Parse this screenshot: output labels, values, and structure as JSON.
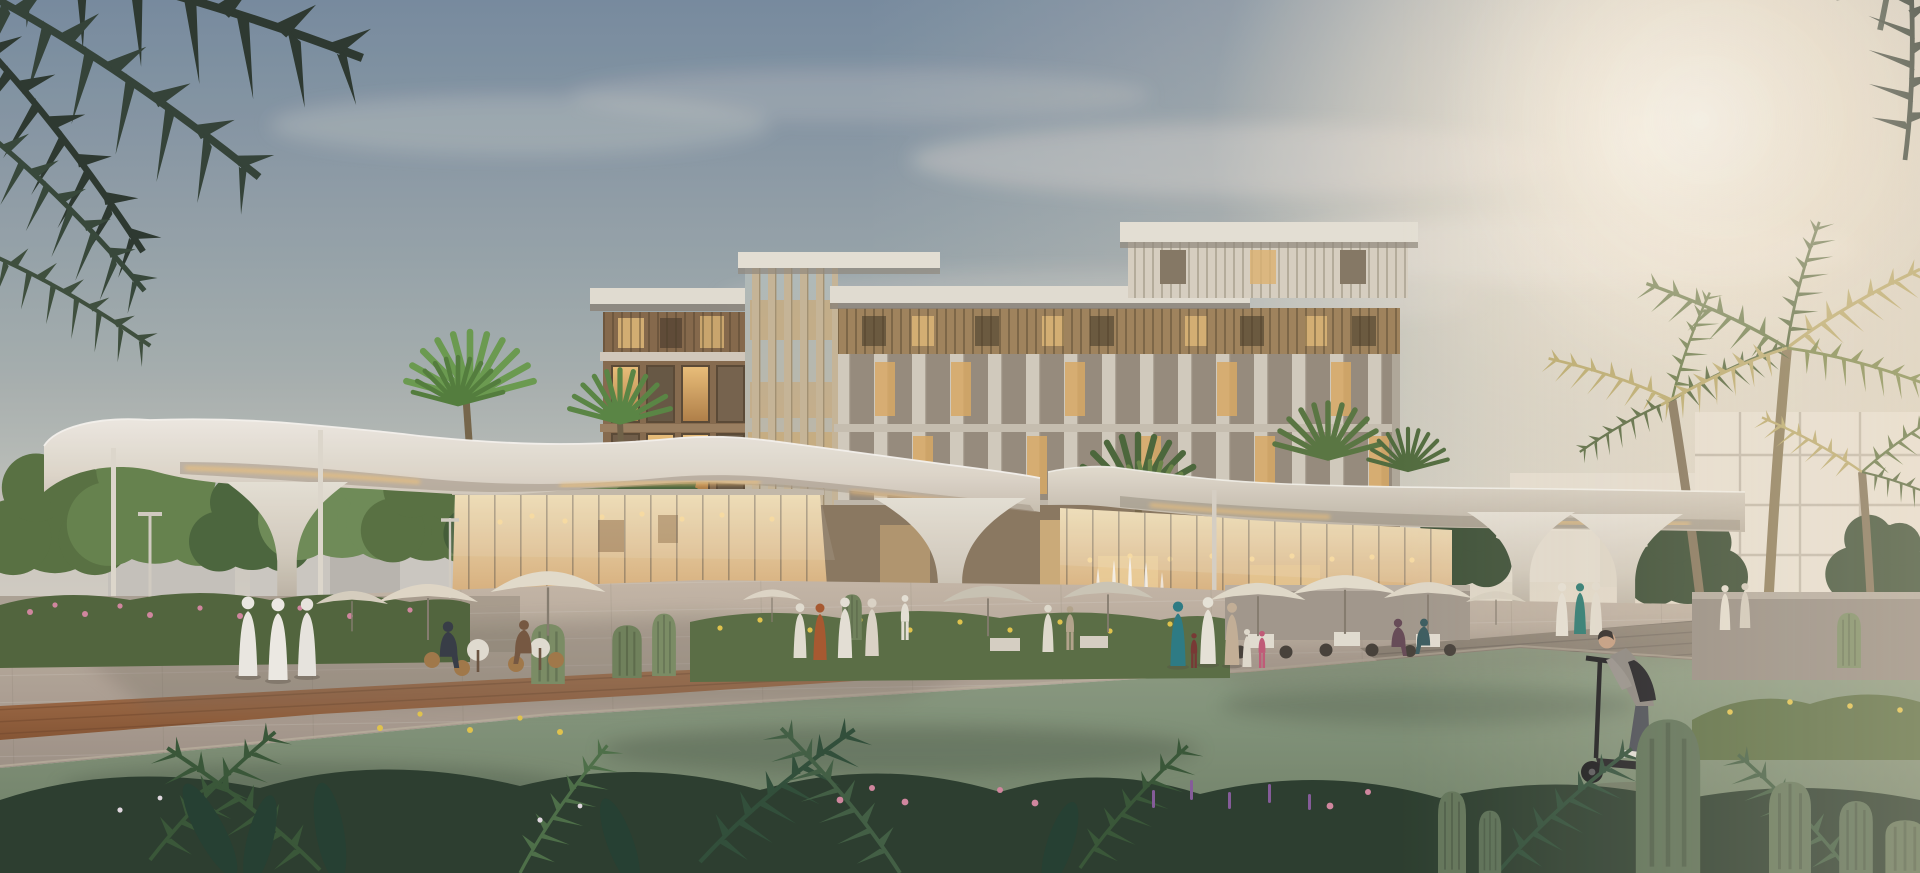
{
  "meta": {
    "type": "architectural-rendering",
    "description": "Photorealistic dusk rendering of a mixed-use community hub: a 5-storey stone-and-timber apartment building behind two glass cafe pavilions sheltered by sculptural white canopies on tulip-shaped columns, framed by palm trees, lawns, cacti planting beds, outdoor diners, strolling families in traditional dress and a man riding an e-scooter.",
    "width_px": 1920,
    "height_px": 873
  },
  "palette": {
    "sky_top": "#7b8fa3",
    "sky_mid": "#c9cbc4",
    "sky_warm": "#f4e9d6",
    "sun_glow": "#fff6e2",
    "cloud": "#f7f0e4",
    "canopy_white": "#efe9de",
    "canopy_underside": "#b3a898",
    "led_strip": "#f6c87e",
    "facade_brown": "#8b6f51",
    "facade_stone": "#cfc7b8",
    "facade_louvre": "#a5885f",
    "window_glow": "#e8b96e",
    "window_cool": "#9c9080",
    "glass_interior_warm": "#f3ddae",
    "pendant_light": "#ffdf9d",
    "paving_lit": "#c3b4a2",
    "paving_shadow": "#8f8476",
    "deck_wood": "#a5714e",
    "deck_gray": "#968b7c",
    "lawn_green": "#87997f",
    "lawn_shadow": "#5f7458",
    "hedge_green": "#55693f",
    "foliage_mid": "#5c7544",
    "foliage_dark": "#2f3b31",
    "palm_backlit": "#c2b274",
    "cactus_green": "#7f9168",
    "flower_pink": "#d88ba3",
    "flower_yellow": "#e8c94f",
    "flower_purple": "#8a5f9e",
    "robe_white": "#efece4",
    "robe_teal": "#2f7f88",
    "robe_orange": "#ad5c31",
    "dress_pink": "#c75e7b",
    "scooter_rider_jacket": "#8e8982",
    "backpack_black": "#1f1f23"
  },
  "scene": {
    "sky": {
      "label": "dusk sky with warm glow on the right"
    },
    "background": {
      "label": "low warehouse blocks left, white low-rise buildings right"
    },
    "main_building": {
      "label": "5-storey residential block, brown wing + fin tower + stone wing with penthouse",
      "lit_windows": true
    },
    "canopies": {
      "label": "organic white canopies on flaring tulip columns",
      "tulip_columns": 4,
      "slim_posts": 3
    },
    "pavilions": {
      "label": "two glass cafe pavilions with warm interiors and pendant lights",
      "count": 2
    },
    "water_feature": {
      "label": "fountain jets in planting bed",
      "jets": 5
    },
    "vegetation": {
      "label": "palms, deciduous trees, hedges, barrel and columnar cacti, flowering shrubs"
    },
    "people": {
      "label": "pedestrians, outdoor diners, family in traditional dress, e-scooter rider",
      "approx_count": 24
    },
    "vehicles": {
      "label": "parked cars behind left hedge",
      "count": 4
    },
    "furniture": {
      "label": "market umbrellas and cafe tables",
      "umbrellas": 10
    }
  }
}
